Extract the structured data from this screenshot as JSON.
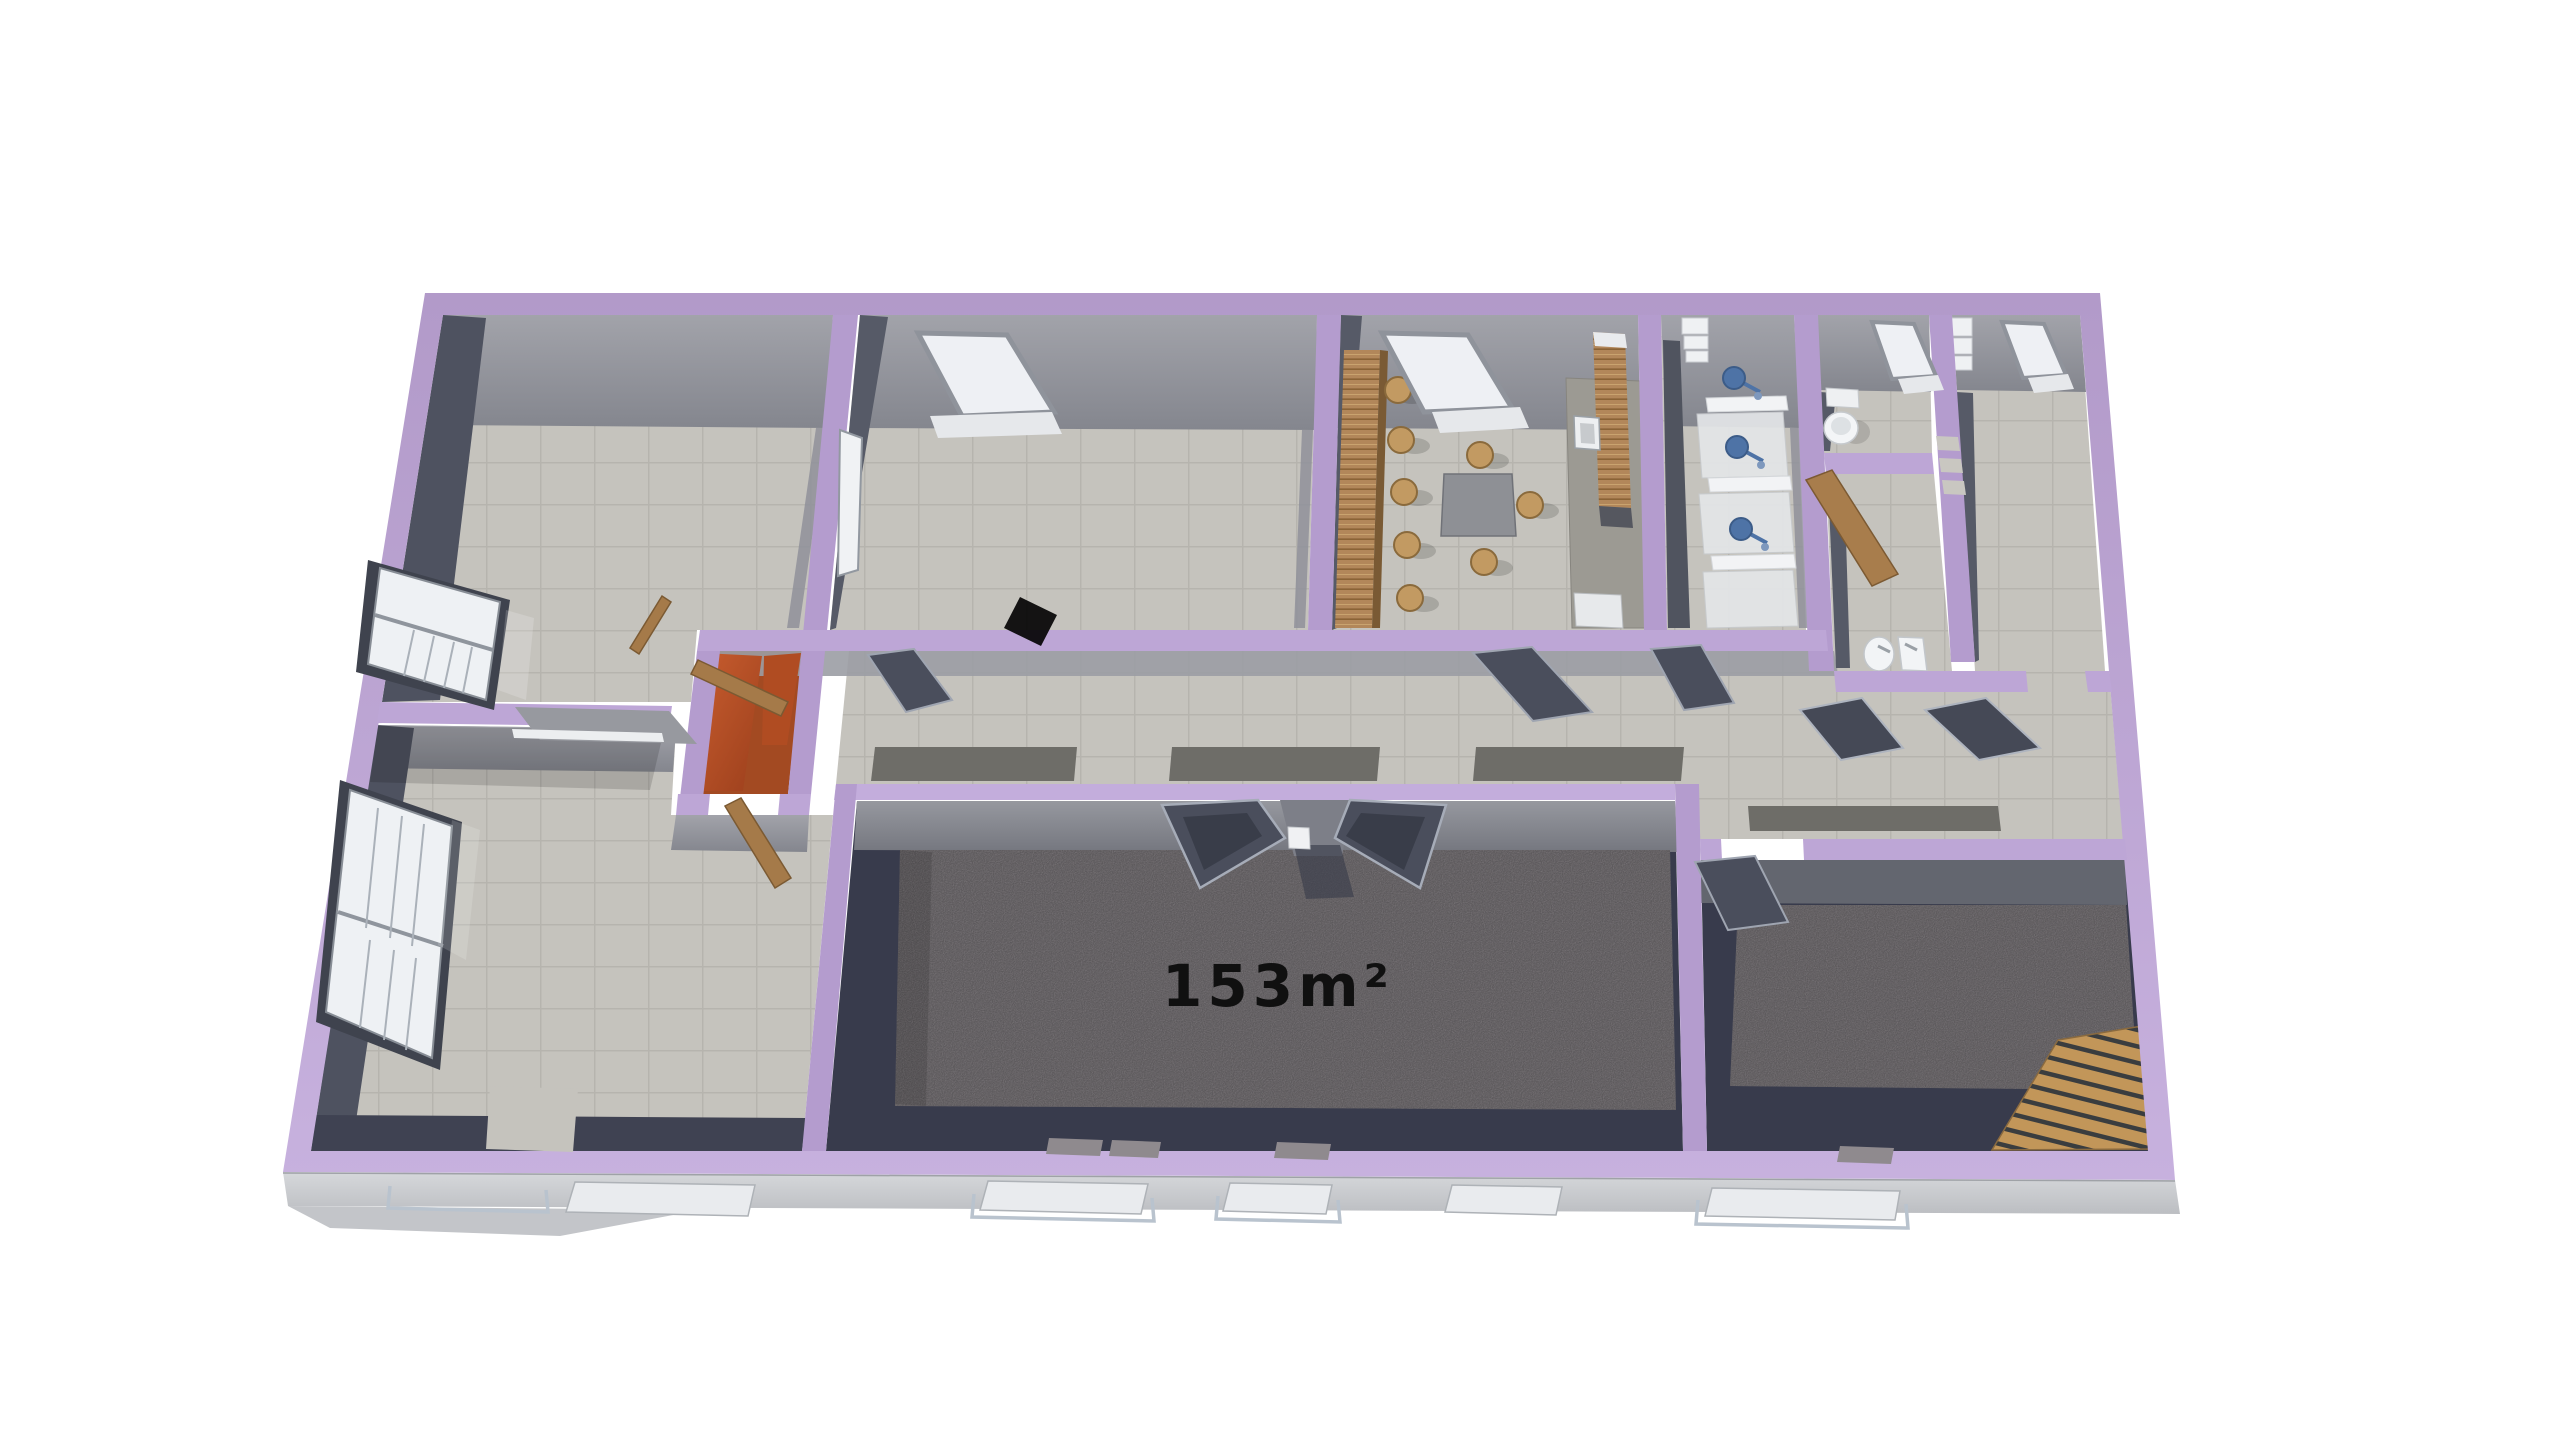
{
  "scene": {
    "type": "3d-floor-plan-render",
    "label": {
      "text": "153m²",
      "color": "#101010"
    },
    "colors": {
      "background": "#ffffff",
      "wall_purple": "#b7a0d1",
      "wall_purple_light": "#c7b1de",
      "wall_purple_dark": "#a78dc1",
      "floor_tile": "#c5c3bd",
      "tile_line": "#b6b4ae",
      "wall_face_light": "#9a9ca3",
      "wall_face_dark": "#4e5260",
      "carpet": "#8f8a8e",
      "carpet_border": "#383b4c",
      "accent_orange": "#c05429",
      "wood": "#a87d4c",
      "fixture_white": "#eff1f3",
      "fixture_blue": "#4e73a6",
      "door_leaf": "#4a4e5c",
      "runner_mat": "#6e6d68",
      "facade": "#cdd0d4"
    },
    "rooms": [
      {
        "id": "room-top-left",
        "floor": "tile",
        "fixtures": [
          "window"
        ]
      },
      {
        "id": "room-top-middle",
        "floor": "tile",
        "fixtures": [
          "skylight",
          "interior-window",
          "door"
        ]
      },
      {
        "id": "kitchen-dining",
        "floor": "tile",
        "fixtures": [
          "skylight",
          "bar-counter",
          "bar-stools",
          "dining-table",
          "chairs",
          "kitchen-counter",
          "island",
          "sink"
        ]
      },
      {
        "id": "shower-room",
        "floor": "tile",
        "fixtures": [
          "shower-stalls",
          "shower-heads",
          "shelf"
        ]
      },
      {
        "id": "wc",
        "floor": "tile",
        "fixtures": [
          "toilet",
          "skylight"
        ]
      },
      {
        "id": "washroom",
        "floor": "tile",
        "fixtures": [
          "washbasins",
          "wood-door",
          "wall-openings"
        ]
      },
      {
        "id": "room-top-right",
        "floor": "tile",
        "fixtures": [
          "skylight",
          "cabinet"
        ]
      },
      {
        "id": "hallway",
        "floor": "tile",
        "fixtures": [
          "runner-mats",
          "open-doors"
        ]
      },
      {
        "id": "vestibule",
        "floor": "tile",
        "fixtures": [
          "orange-walls",
          "wood-doors"
        ]
      },
      {
        "id": "room-bottom-left",
        "floor": "tile",
        "fixtures": [
          "windows",
          "pass-through-hatch"
        ]
      },
      {
        "id": "main-hall",
        "floor": "carpet",
        "fixtures": [
          "double-doors",
          "area-label"
        ]
      },
      {
        "id": "room-bottom-right",
        "floor": "carpet",
        "fixtures": [
          "door",
          "wood-deck"
        ]
      }
    ]
  }
}
